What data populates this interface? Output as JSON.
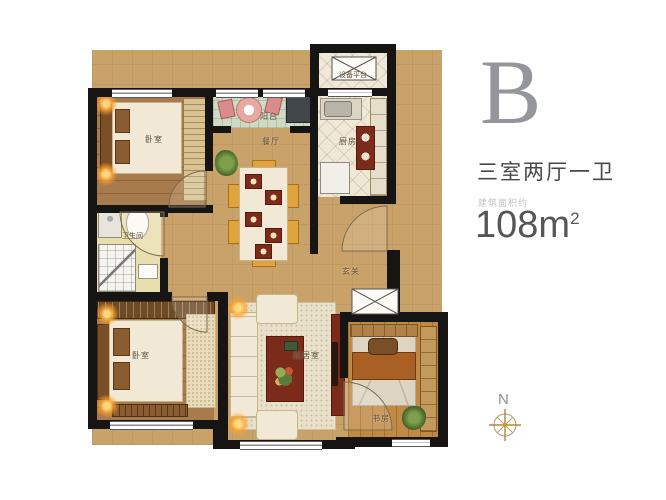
{
  "rooms": {
    "bedroom_top": "卧室",
    "balcony": "阳台",
    "dining": "餐厅",
    "kitchen": "厨房",
    "equipment_platform": "设备平台",
    "bathroom": "卫生间",
    "bedroom_bottom": "卧室",
    "living": "起居室",
    "entry": "玄关",
    "study": "书房"
  },
  "info": {
    "unit_letter": "B",
    "unit_type": "三室两厅一卫",
    "area_prefix": "建筑面积约",
    "area_number": "108",
    "area_unit": "m",
    "area_exponent": "2"
  },
  "compass": {
    "north": "N"
  },
  "colors": {
    "wall": "#171513",
    "floor_tan": "#c9a269",
    "balcony_green": "#cfdac5",
    "accent_red": "#7c2a1a",
    "lamp_glow": "#ffb347",
    "headline_gray": "#94969c",
    "text_dark": "#48484a"
  }
}
